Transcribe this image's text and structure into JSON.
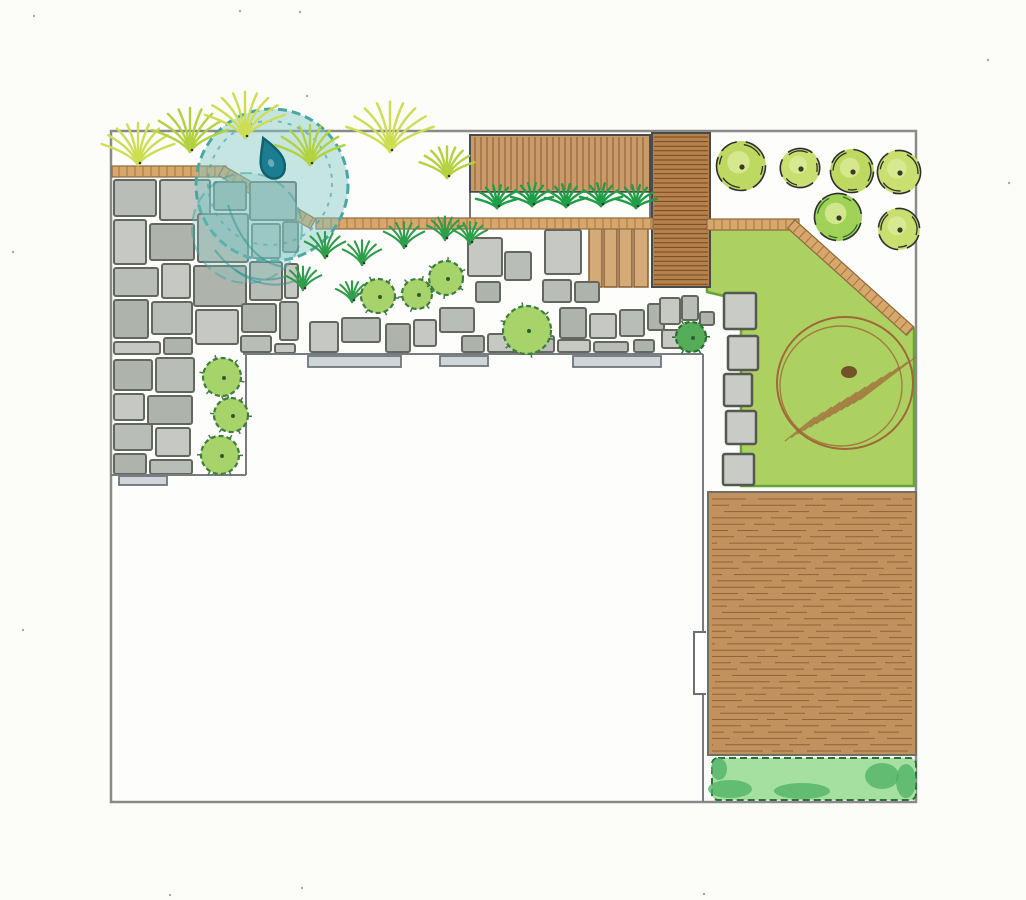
{
  "meta": {
    "kind": "hand-drawn garden landscape design plan, top view",
    "canvas": {
      "width": 1026,
      "height": 900
    }
  },
  "colors": {
    "paper": "#fcfcf9",
    "wall": "#8a8a8a",
    "inner_line": "#787c7e",
    "stone_fill": "#b9bdb7",
    "stone_fill_alt": "#c6c9c3",
    "stone_fill_dark": "#aeb3ac",
    "stone_stroke": "#63675f",
    "slat_fill": "#cfd6da",
    "slat_stroke": "#6e7478",
    "edging_fill": "#d8a76c",
    "edging_stroke": "#8a6a40",
    "edging_tick": "#a5723c",
    "deck_fill": "#c89b68",
    "deck_line": "#8a5a2c",
    "walk_fill": "#b5824e",
    "walk_line": "#76481f",
    "bigdeck_fill": "#c2925e",
    "bigdeck_line": "#8a5b30",
    "bigdeck_stroke": "#6f6f66",
    "step_fill": "#d4ab77",
    "step_stroke": "#8a5c2e",
    "lawn_fill": "#acd161",
    "lawn_stroke": "#67a33b",
    "tree_fill": "#bed962",
    "tree_fill_alt": "#c9e070",
    "tree_accent": "#9fd257",
    "tree_inner": "#d9ea96",
    "sketch": "#2e2e2e",
    "shrub_light": "#a7d46a",
    "shrub_light_stroke": "#3e7d3e",
    "shrub_dark": "#55ac59",
    "shrub_dark_stroke": "#2c6e31",
    "grass_light": "#b3d23f",
    "grass_light2": "#cede52",
    "tuft_dark": "#2f9e4a",
    "bed_plant": "#1f9e47",
    "pond_fill": "rgba(128,200,197,0.45)",
    "pond_fill2": "rgba(128,200,197,0.30)",
    "pond_stroke": "#49a8a4",
    "drop_fill": "#1b7e90",
    "drop_stroke": "#13606f",
    "hedge_fill": "#a5e0a0",
    "hedge_dark": "#4cb263",
    "hedge_stroke": "#2f6f3a",
    "pencil_brown": "#a0673a",
    "blob_brown": "#6b4423",
    "speckle": "#555555"
  },
  "plan": {
    "boundary": [
      111,
      131,
      805,
      671
    ],
    "inner_lines": [
      [
        243,
        354,
        703,
        354
      ],
      [
        703,
        354,
        703,
        802
      ],
      [
        246,
        354,
        246,
        475
      ],
      [
        111,
        475,
        246,
        475
      ]
    ],
    "gate": [
      694,
      632,
      12,
      62
    ],
    "lawn_points": "707,228 797,224 914,329 914,486 741,486 741,300 707,292",
    "big_deck": [
      708,
      492,
      208,
      263
    ],
    "hedge": [
      712,
      758,
      204,
      42
    ],
    "hedge_blobs": [
      [
        730,
        789,
        22,
        9
      ],
      [
        802,
        791,
        28,
        8
      ],
      [
        882,
        776,
        17,
        13
      ],
      [
        906,
        781,
        10,
        17
      ],
      [
        719,
        769,
        8,
        11
      ]
    ],
    "deck_seat": [
      470,
      135,
      180,
      57
    ],
    "plant_bed": [
      470,
      192,
      180,
      27
    ],
    "boardwalk": [
      652,
      133,
      58,
      154
    ],
    "steps": [
      [
        589,
        228,
        13,
        59
      ],
      [
        604,
        228,
        13,
        59
      ],
      [
        619,
        228,
        13,
        59
      ],
      [
        634,
        228,
        14,
        59
      ]
    ],
    "edging_segments": [
      {
        "x": 112,
        "y": 166,
        "len": 114,
        "angle": 0
      },
      {
        "x": 224,
        "y": 166,
        "len": 106,
        "angle": 30
      },
      {
        "x": 316,
        "y": 218,
        "len": 337,
        "angle": 0
      },
      {
        "x": 707,
        "y": 219,
        "len": 92,
        "angle": 0
      },
      {
        "x": 795,
        "y": 220,
        "len": 160,
        "angle": 42
      }
    ],
    "pond": {
      "outer": [
        272,
        185,
        76
      ],
      "inner": [
        247,
        228,
        55
      ],
      "ring": [
        270,
        183,
        62
      ],
      "drop": [
        273,
        160,
        -24
      ]
    },
    "canopy_sketch": {
      "cx": 845,
      "cy": 383,
      "rx": 68,
      "ry": 66
    },
    "crazy_stones": [
      [
        114,
        180,
        42,
        36
      ],
      [
        160,
        180,
        50,
        40
      ],
      [
        214,
        182,
        32,
        28
      ],
      [
        250,
        182,
        46,
        38
      ],
      [
        114,
        220,
        32,
        44
      ],
      [
        150,
        224,
        44,
        36
      ],
      [
        198,
        214,
        50,
        48
      ],
      [
        252,
        224,
        28,
        34
      ],
      [
        283,
        222,
        15,
        30
      ],
      [
        114,
        268,
        44,
        28
      ],
      [
        162,
        264,
        28,
        34
      ],
      [
        194,
        266,
        52,
        40
      ],
      [
        250,
        262,
        32,
        38
      ],
      [
        285,
        264,
        13,
        34
      ],
      [
        114,
        300,
        34,
        38
      ],
      [
        152,
        302,
        40,
        32
      ],
      [
        196,
        310,
        42,
        34
      ],
      [
        242,
        304,
        34,
        28
      ],
      [
        280,
        302,
        18,
        38
      ],
      [
        114,
        342,
        46,
        12
      ],
      [
        164,
        338,
        28,
        16
      ],
      [
        241,
        336,
        30,
        16
      ],
      [
        275,
        344,
        20,
        9
      ],
      [
        114,
        360,
        38,
        30
      ],
      [
        156,
        358,
        38,
        34
      ],
      [
        114,
        394,
        30,
        26
      ],
      [
        148,
        396,
        44,
        28
      ],
      [
        114,
        424,
        38,
        26
      ],
      [
        156,
        428,
        34,
        28
      ],
      [
        114,
        454,
        32,
        20
      ],
      [
        150,
        460,
        42,
        14
      ]
    ],
    "band_slabs": [
      [
        468,
        238,
        34,
        38
      ],
      [
        505,
        252,
        26,
        28
      ],
      [
        476,
        282,
        24,
        20
      ],
      [
        545,
        230,
        36,
        44
      ],
      [
        543,
        280,
        28,
        22
      ],
      [
        575,
        282,
        24,
        20
      ],
      [
        310,
        322,
        28,
        30
      ],
      [
        342,
        318,
        38,
        24
      ],
      [
        386,
        324,
        24,
        28
      ],
      [
        414,
        320,
        22,
        26
      ],
      [
        440,
        308,
        34,
        24
      ],
      [
        462,
        336,
        22,
        16
      ],
      [
        488,
        334,
        34,
        18
      ],
      [
        526,
        336,
        28,
        16
      ],
      [
        560,
        308,
        26,
        30
      ],
      [
        590,
        314,
        26,
        24
      ],
      [
        620,
        310,
        24,
        26
      ],
      [
        648,
        304,
        16,
        26
      ],
      [
        558,
        340,
        32,
        12
      ],
      [
        594,
        342,
        34,
        10
      ],
      [
        634,
        340,
        20,
        12
      ],
      [
        660,
        298,
        20,
        26
      ],
      [
        682,
        296,
        16,
        24
      ],
      [
        700,
        312,
        14,
        13
      ],
      [
        662,
        330,
        24,
        18
      ]
    ],
    "step_slats": [
      [
        308,
        356,
        93,
        11
      ],
      [
        440,
        356,
        48,
        10
      ],
      [
        573,
        356,
        88,
        11
      ],
      [
        119,
        476,
        48,
        9
      ]
    ],
    "stepping_stones": [
      [
        724,
        293,
        32,
        36
      ],
      [
        728,
        336,
        30,
        34
      ],
      [
        724,
        374,
        28,
        32
      ],
      [
        726,
        411,
        30,
        33
      ],
      [
        723,
        454,
        31,
        31
      ]
    ],
    "trees": [
      {
        "cx": 741,
        "cy": 166,
        "r": 25
      },
      {
        "cx": 800,
        "cy": 168,
        "r": 20
      },
      {
        "cx": 852,
        "cy": 171,
        "r": 22
      },
      {
        "cx": 899,
        "cy": 172,
        "r": 22
      },
      {
        "cx": 838,
        "cy": 217,
        "r": 24,
        "accent": true
      },
      {
        "cx": 899,
        "cy": 229,
        "r": 21
      }
    ],
    "shrubs": [
      {
        "cx": 378,
        "cy": 296,
        "r": 17,
        "tone": "light"
      },
      {
        "cx": 417,
        "cy": 294,
        "r": 15,
        "tone": "light"
      },
      {
        "cx": 446,
        "cy": 278,
        "r": 17,
        "tone": "light"
      },
      {
        "cx": 527,
        "cy": 330,
        "r": 24,
        "tone": "light"
      },
      {
        "cx": 691,
        "cy": 337,
        "r": 15,
        "tone": "dark"
      },
      {
        "cx": 222,
        "cy": 377,
        "r": 19,
        "tone": "light"
      },
      {
        "cx": 231,
        "cy": 415,
        "r": 17,
        "tone": "light"
      },
      {
        "cx": 220,
        "cy": 455,
        "r": 19,
        "tone": "light"
      }
    ],
    "grass_clumps": [
      [
        138,
        165,
        1.0
      ],
      [
        190,
        152,
        1.05
      ],
      [
        245,
        138,
        1.1
      ],
      [
        310,
        165,
        0.95
      ],
      [
        390,
        152,
        1.2
      ],
      [
        447,
        178,
        0.75
      ]
    ],
    "dark_tufts": [
      [
        325,
        258,
        1
      ],
      [
        303,
        290,
        0.9
      ],
      [
        362,
        265,
        0.95
      ],
      [
        404,
        248,
        1
      ],
      [
        445,
        240,
        0.9
      ],
      [
        352,
        302,
        0.8
      ],
      [
        470,
        244,
        0.85
      ]
    ],
    "bed_plants": [
      [
        497,
        208
      ],
      [
        532,
        206
      ],
      [
        566,
        207
      ],
      [
        601,
        206
      ],
      [
        636,
        208
      ]
    ],
    "speckles": [
      [
        34,
        16
      ],
      [
        240,
        11
      ],
      [
        300,
        12
      ],
      [
        13,
        252
      ],
      [
        1009,
        183
      ],
      [
        23,
        630
      ],
      [
        302,
        888
      ],
      [
        704,
        894
      ],
      [
        170,
        895
      ],
      [
        988,
        60
      ],
      [
        237,
        103
      ],
      [
        307,
        96
      ]
    ]
  }
}
